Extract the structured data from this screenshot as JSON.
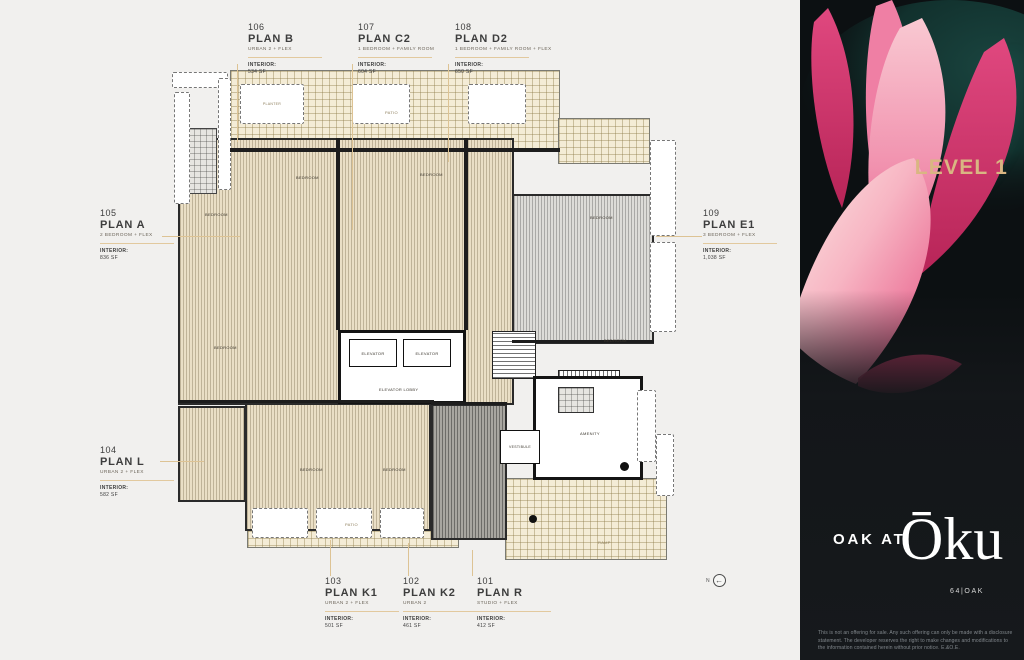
{
  "callouts": [
    {
      "id": "106",
      "plan": "PLAN B",
      "type": "URBAN 2 + FLEX",
      "interior_label": "INTERIOR:",
      "area": "534 SF"
    },
    {
      "id": "107",
      "plan": "PLAN C2",
      "type": "1 BEDROOM + FAMILY ROOM",
      "interior_label": "INTERIOR:",
      "area": "604 SF"
    },
    {
      "id": "108",
      "plan": "PLAN D2",
      "type": "1 BEDROOM + FAMILY ROOM + FLEX",
      "interior_label": "INTERIOR:",
      "area": "650 SF"
    },
    {
      "id": "105",
      "plan": "PLAN A",
      "type": "2 BEDROOM + FLEX",
      "interior_label": "INTERIOR:",
      "area": "836 SF"
    },
    {
      "id": "109",
      "plan": "PLAN E1",
      "type": "3 BEDROOM + FLEX",
      "interior_label": "INTERIOR:",
      "area": "1,038 SF"
    },
    {
      "id": "104",
      "plan": "PLAN L",
      "type": "URBAN 2 + FLEX",
      "interior_label": "INTERIOR:",
      "area": "582 SF"
    },
    {
      "id": "103",
      "plan": "PLAN K1",
      "type": "URBAN 2 + FLEX",
      "interior_label": "INTERIOR:",
      "area": "501 SF"
    },
    {
      "id": "102",
      "plan": "PLAN K2",
      "type": "URBAN 2",
      "interior_label": "INTERIOR:",
      "area": "461 SF"
    },
    {
      "id": "101",
      "plan": "PLAN R",
      "type": "STUDIO + FLEX",
      "interior_label": "INTERIOR:",
      "area": "412 SF"
    }
  ],
  "rooms": {
    "bedroom": "BEDROOM",
    "patio": "PATIO",
    "planter": "PLANTER",
    "elevator": "ELEVATOR",
    "elevator_lobby": "ELEVATOR LOBBY",
    "amenity": "AMENITY",
    "vestibule": "VESTIBULE",
    "ramp": "RAMP"
  },
  "panel": {
    "level_title": "LEVEL 1",
    "brand_prefix": "OAK AT",
    "brand_name": "Ōku",
    "brand_sub": "64|OAK",
    "disclaimer": "This is not an offering for sale. Any such offering can only be made with a disclosure statement. The developer reserves the right to make changes and modifications to the information contained herein without prior notice. E.&O.E."
  },
  "compass": {
    "label": "N"
  },
  "colors": {
    "accent_gold": "#d9b682",
    "panel_bg": "#14171a",
    "lead_line": "#ddc394"
  }
}
